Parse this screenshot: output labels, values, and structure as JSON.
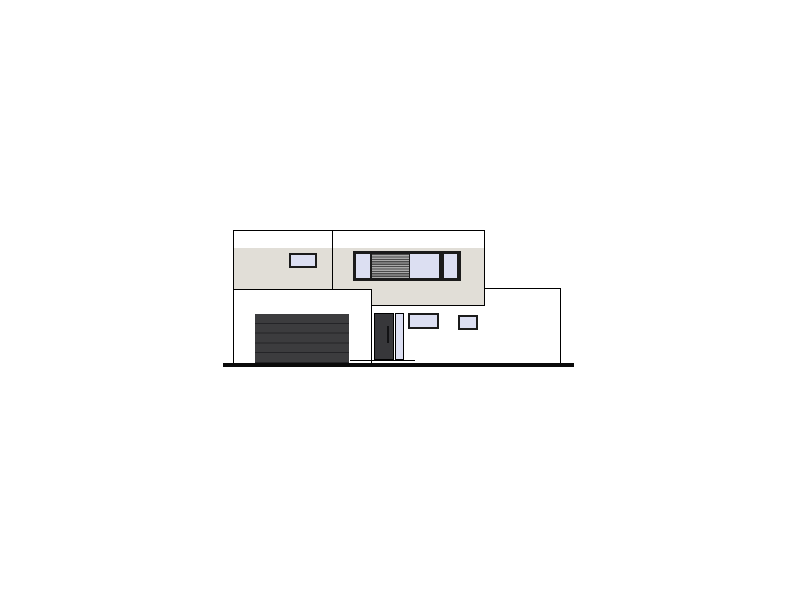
{
  "scene": {
    "type": "architectural-elevation-drawing",
    "subject": "front elevation of a modern flat-roof two-story house with garage wing, recessed entry and single-story right wing",
    "visible_text": "none"
  },
  "colors": {
    "outline": "#000000",
    "wall_white": "#ffffff",
    "wall_beige": "#e1ded7",
    "window_glass": "#dcdff2",
    "window_frame": "#1b1b1b",
    "garage_door": "#3c3c3e",
    "garage_seam": "#242427",
    "entry_door": "#37373a",
    "louver_dark": "#4b4b4b",
    "louver_light": "#a9a9a9",
    "ground": "#0a0a0a"
  },
  "elements": [
    {
      "name": "upper-floor-block",
      "role": "two-story facade block, white parapet band over beige wall"
    },
    {
      "name": "parapet-band",
      "role": "white roof parapet strip"
    },
    {
      "name": "facade-divider-line",
      "role": "vertical joint line on upper facade"
    },
    {
      "name": "upper-left-window",
      "role": "small fixed window, upper floor"
    },
    {
      "name": "ribbon-window",
      "role": "wide window unit: pane, louver shutter, two panes"
    },
    {
      "name": "garage-wing",
      "role": "single-story garage volume"
    },
    {
      "name": "garage-door",
      "role": "dark sectional garage door, 5 panels"
    },
    {
      "name": "entry-door",
      "role": "dark entry door with sidelight and handle"
    },
    {
      "name": "entry-window",
      "role": "small window right of door"
    },
    {
      "name": "side-window",
      "role": "small square window far right of entry wall"
    },
    {
      "name": "right-wing",
      "role": "single-story right volume"
    },
    {
      "name": "porch-step-line",
      "role": "thin step line in front of entry"
    },
    {
      "name": "ground-line",
      "role": "thick ground/grade line"
    }
  ]
}
